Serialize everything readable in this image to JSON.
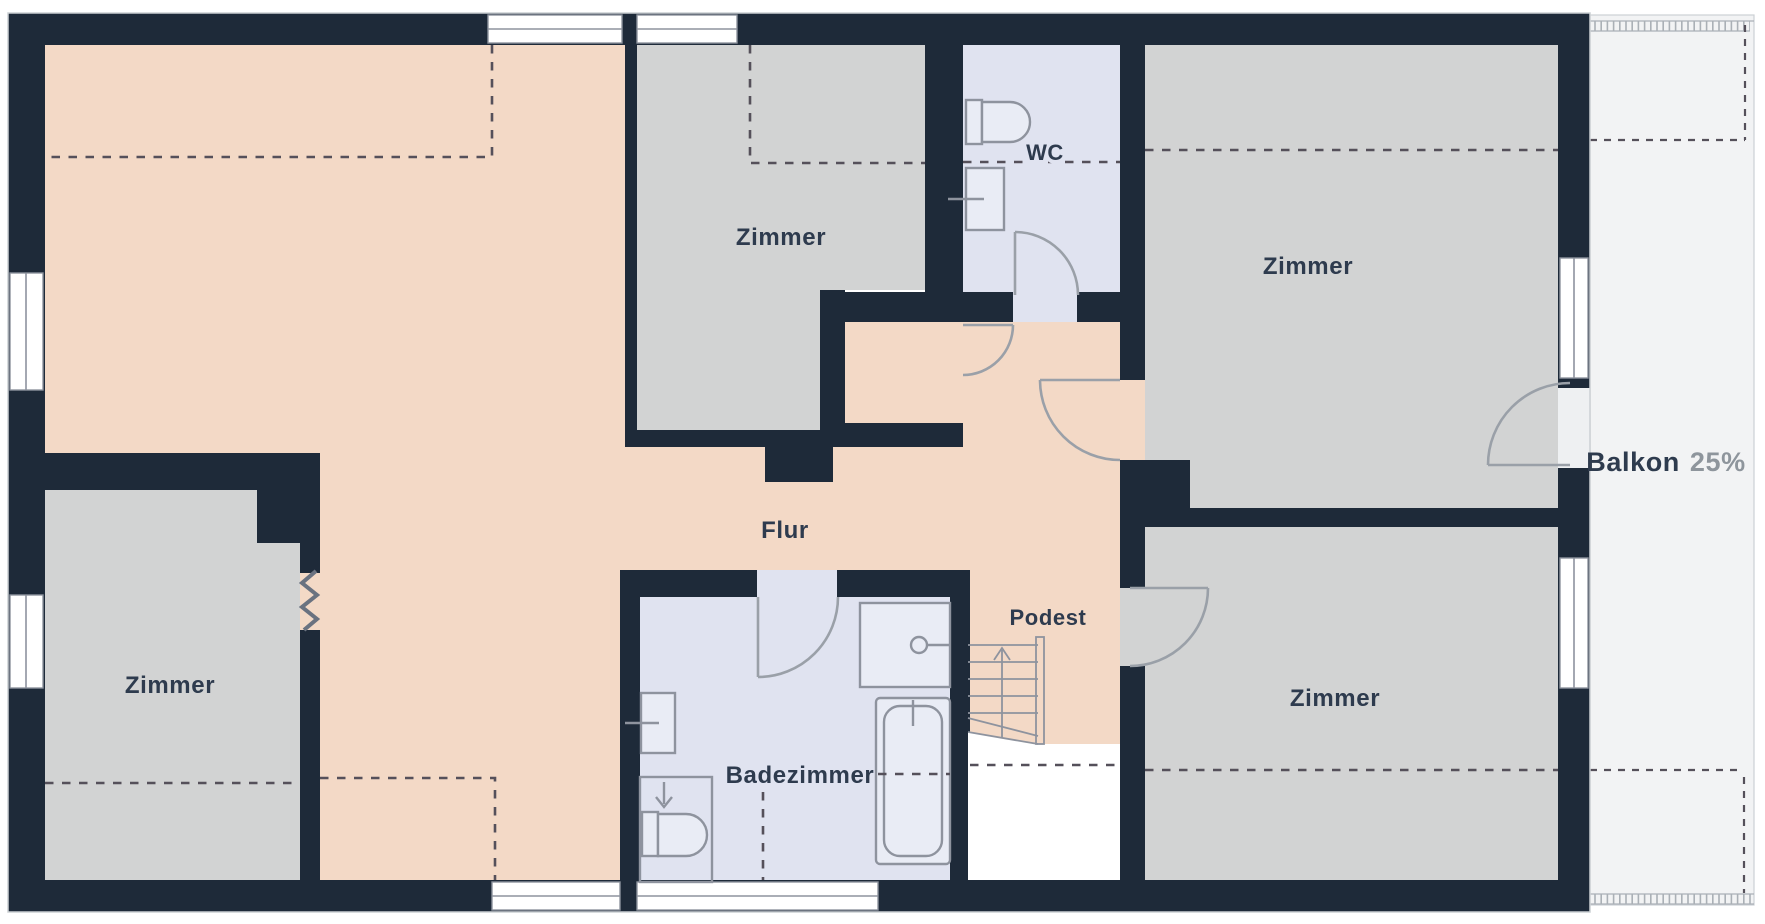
{
  "meta": {
    "type": "floor-plan",
    "language": "de",
    "description": "Upper-floor apartment plan with hallway, four rooms, bathroom, WC, landing with stairs and balcony"
  },
  "colors": {
    "wall": "#1e2a39",
    "hall": "#f3d9c6",
    "room": "#d2d3d3",
    "bath": "#e0e3f0",
    "balcony": "#f2f3f4",
    "void": "#ffffff",
    "fixture": "#8e939e",
    "fixture-fill": "#e9ecf5",
    "door": "#9aa0a8",
    "dash": "#55505a",
    "window-fill": "#ffffff",
    "window-line": "#8e939e",
    "rail": "#aab0b6",
    "outline": "#ccd0d4",
    "zigzag": "#6a7280",
    "label": "#2e3b4e",
    "label-muted": "#8e959c"
  },
  "rooms": [
    {
      "id": "zimmer-top-middle",
      "label": "Zimmer"
    },
    {
      "id": "zimmer-top-right",
      "label": "Zimmer"
    },
    {
      "id": "zimmer-bottom-left",
      "label": "Zimmer"
    },
    {
      "id": "zimmer-bottom-right",
      "label": "Zimmer"
    },
    {
      "id": "flur",
      "label": "Flur"
    },
    {
      "id": "podest",
      "label": "Podest"
    },
    {
      "id": "badezimmer",
      "label": "Badezimmer"
    },
    {
      "id": "wc",
      "label": "WC"
    }
  ],
  "balcony": {
    "label": "Balkon",
    "share": "25%"
  }
}
